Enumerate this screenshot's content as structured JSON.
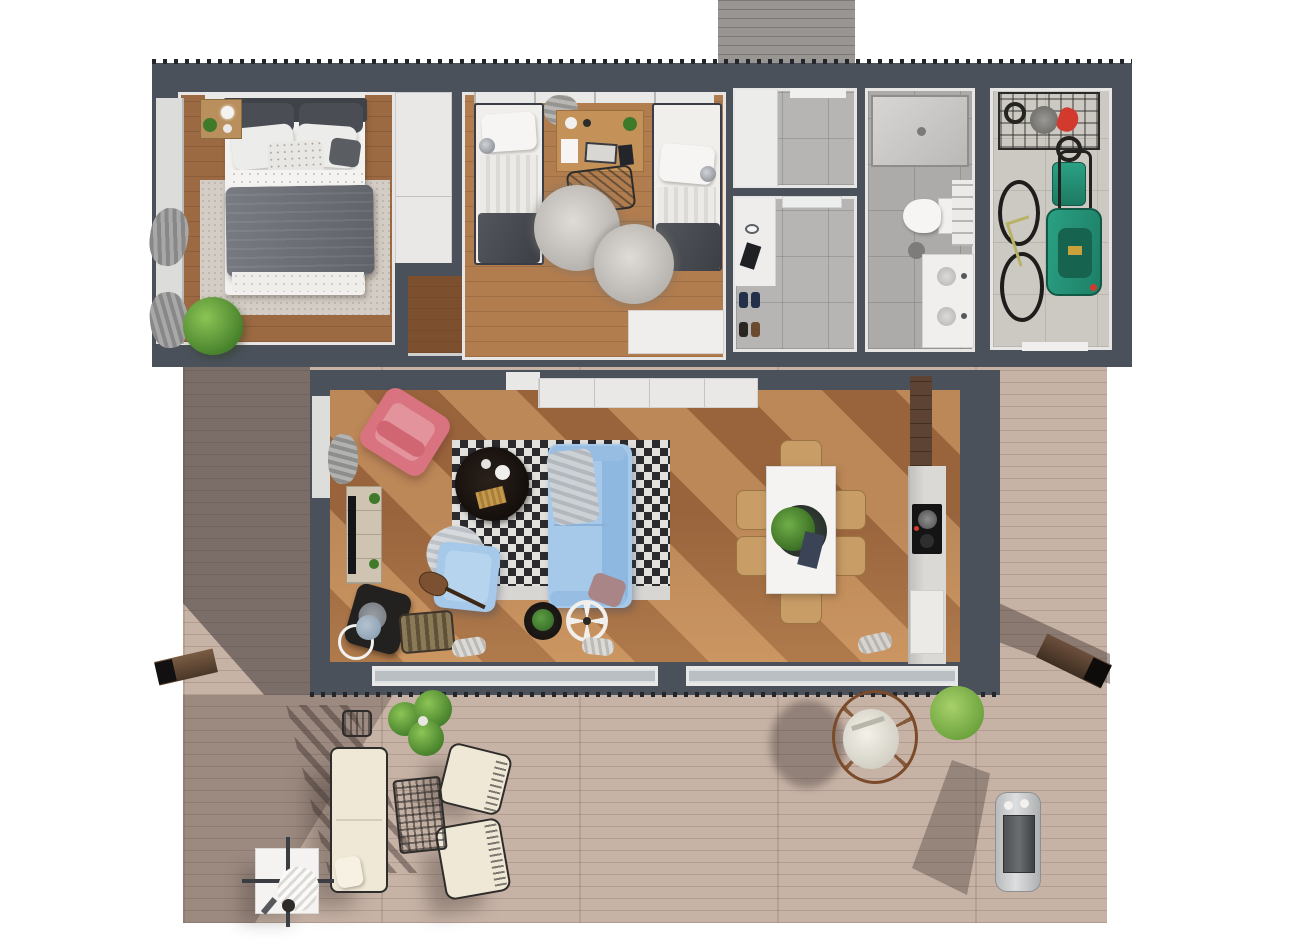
{
  "scene": {
    "title": "3D top-view floor plan render of a single-storey house with wrap deck",
    "type": "architectural-floor-plan-render",
    "width_px": 1300,
    "height_px": 947
  },
  "palette": {
    "background": "#ffffff",
    "exterior_wall": "#4a515b",
    "interior_wall": "#e7e6e4",
    "bedroom_floor": "#9c6a42",
    "kids_floor": "#b17d4f",
    "living_floor": "#99643c",
    "hall_floor": "#7c4f2e",
    "tile_floor": "#b6b5b3",
    "bath_tile": "#adaba9",
    "garage_floor": "#ccc9c3",
    "deck_wood": "#c7b3a6",
    "porch_wood": "#989593",
    "sofa_blue": "#a6c9e9",
    "armchair_pink": "#d8737f",
    "outdoor_cushion_cream": "#efe8d6",
    "lawn_mower_green": "#27997b",
    "plant_green": "#5c9a3a",
    "sunlight": "#ffce8c"
  },
  "rooms": [
    {
      "id": "master-bedroom",
      "label": "Master bedroom",
      "furniture": [
        "double bed with dark grey duvet",
        "white pillows",
        "patterned cushion",
        "headboard",
        "nightstand with lamp and plant",
        "speckled area rug",
        "white wardrobe",
        "potted plant",
        "window wall with grey curtains"
      ]
    },
    {
      "id": "kids-bedroom",
      "label": "Kids bedroom",
      "furniture": [
        "single bed left",
        "single bed right",
        "wall reading lamps",
        "shared desk with laptop and papers",
        "black wire chair",
        "two fluffy round rugs",
        "white dresser",
        "window strip with curtain"
      ]
    },
    {
      "id": "inner-hall",
      "label": "Inner hallway niche",
      "furniture": [
        "dark wood floor",
        "white door casing"
      ]
    },
    {
      "id": "storage-room",
      "label": "Storage / WC",
      "furniture": [
        "white closet",
        "grey tile floor"
      ]
    },
    {
      "id": "entry-hall",
      "label": "Entry hall",
      "furniture": [
        "white sideboard",
        "shoes pairs",
        "grey tile floor"
      ]
    },
    {
      "id": "bathroom",
      "label": "Bathroom",
      "furniture": [
        "walk-in shower",
        "toilet with cistern",
        "waste bin",
        "double-sink vanity",
        "towel shelf"
      ]
    },
    {
      "id": "garage",
      "label": "Garage / utility room",
      "furniture": [
        "wall rack with tools and red gloves",
        "bicycle",
        "green lawn mower",
        "battery trimmer with coiled cable",
        "exterior door"
      ]
    },
    {
      "id": "living-room",
      "label": "Living room",
      "furniture": [
        "pink armchair",
        "blue two-seat sofa",
        "blue armchair with throw",
        "round black coffee table",
        "black & white checkered rug",
        "TV console with TV",
        "black reading chair",
        "wire basket with blanket",
        "guitar",
        "floor lamp",
        "black side table with plant",
        "white round tray fan",
        "white sideboard",
        "sliding glass doors",
        "window with curtain"
      ]
    },
    {
      "id": "dining-area",
      "label": "Dining area",
      "furniture": [
        "white rectangular table",
        "six wooden chairs",
        "green centerpiece with tray",
        "napkin"
      ]
    },
    {
      "id": "kitchen",
      "label": "Kitchen",
      "furniture": [
        "tall wood cabinet",
        "counter run",
        "black cooktop with pot",
        "white appliance front"
      ]
    },
    {
      "id": "deck",
      "label": "Outdoor deck",
      "furniture": [
        "outdoor sofa cream",
        "outdoor armchair upper",
        "outdoor armchair lower",
        "wire mesh coffee table",
        "white side table with towel",
        "wire stool",
        "large potted plant",
        "hanging egg chair",
        "light green potted plant",
        "stainless BBQ grill",
        "timber beam left",
        "timber beam right"
      ]
    },
    {
      "id": "porch",
      "label": "Entry porch (grey timber)",
      "furniture": []
    }
  ],
  "counts": {
    "bedrooms": 2,
    "single_beds": 2,
    "dining_chairs": 6,
    "outdoor_armchairs": 2,
    "glass_door_runs": 2
  }
}
